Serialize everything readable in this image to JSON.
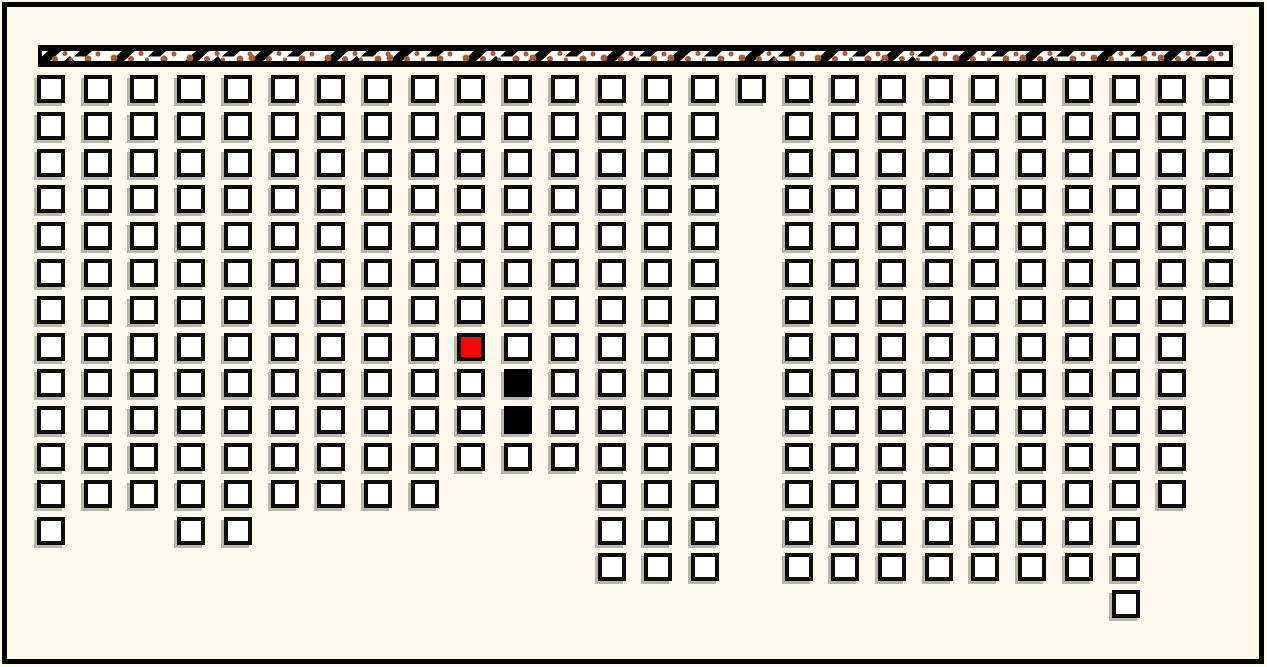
{
  "app": {
    "type": "hall-seat-map",
    "description": "Grid seat/cell map with screen strip at top, one selected (red) cell and two occupied (black) cells"
  },
  "colors": {
    "background": "#fbfaec",
    "frame": "#000000",
    "seat_fill": "#ffffff",
    "seat_border": "#0d0d0d",
    "seat_shadow": "rgba(130,128,118,0.55)",
    "selected_fill": "#fa0505",
    "occupied_fill": "#000000",
    "screen_fill": "#ffffff",
    "screen_border": "#000000",
    "screen_notch": "#000000",
    "screen_dot": "#a95c33"
  },
  "frame": {
    "inset": 2,
    "thickness": 5
  },
  "screen": {
    "x": 38,
    "y": 45,
    "width": 1195,
    "height": 22,
    "border_thickness": 6,
    "notch_pitch": 70
  },
  "grid": {
    "columns": 26,
    "rows": 15,
    "origin_x": 37,
    "origin_y": 75,
    "pitch_x": 46.72,
    "pitch_y": 36.8,
    "cell_w": 28,
    "cell_h": 28,
    "cell_border": 4,
    "legend": {
      "O": "available",
      "R": "selected",
      "B": "occupied",
      ".": "no-cell"
    },
    "cells": [
      "OOOOOOOOOOOOOOOOOOOOOOOOOO",
      "OOOOOOOOOOOOOOO.OOOOOOOOOO",
      "OOOOOOOOOOOOOOO.OOOOOOOOOO",
      "OOOOOOOOOOOOOOO.OOOOOOOOOO",
      "OOOOOOOOOOOOOOO.OOOOOOOOOO",
      "OOOOOOOOOOOOOOO.OOOOOOOOOO",
      "OOOOOOOOOOOOOOO.OOOOOOOOOO",
      "OOOOOOOOOROOOOO.OOOOOOOOO.",
      "OOOOOOOOOOBOOOO.OOOOOOOOO.",
      "OOOOOOOOOOBOOOO.OOOOOOOOO.",
      "OOOOOOOOOOOOOOO.OOOOOOOOO.",
      "OOOOOOOOO...OOO.OOOOOOOOO.",
      "O..OO.......OOO.OOOOOOOO..",
      "............OOO.OOOOOOOO..",
      ".......................O.."
    ],
    "selected_cell": {
      "col": 9,
      "row": 7
    },
    "occupied_cells": [
      {
        "col": 10,
        "row": 8
      },
      {
        "col": 10,
        "row": 9
      }
    ]
  },
  "counts": {
    "total_cells": 319,
    "available": 316,
    "selected": 1,
    "occupied": 2
  }
}
